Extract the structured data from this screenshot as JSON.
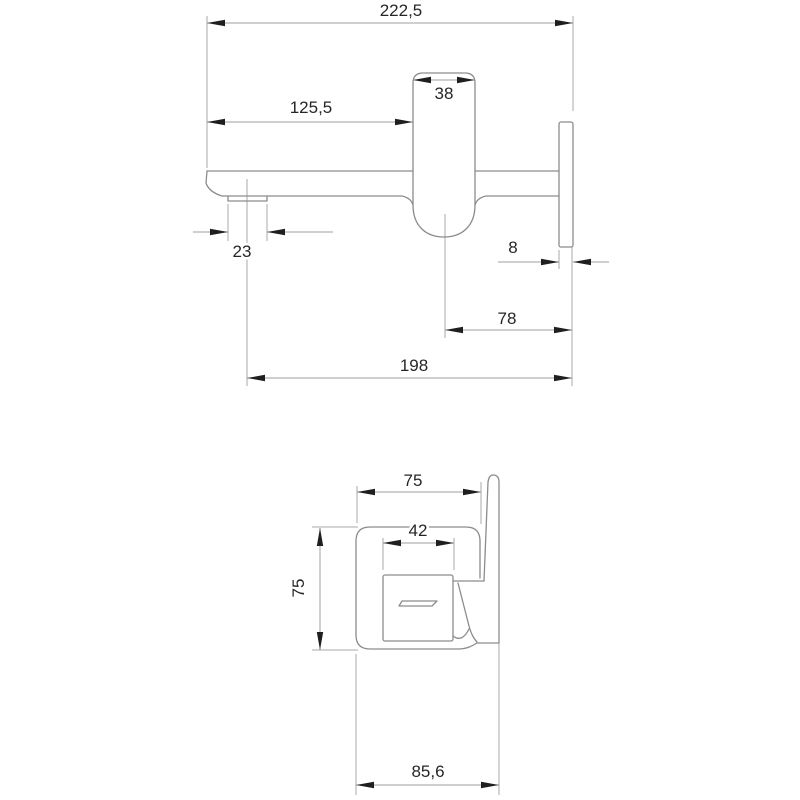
{
  "drawing": {
    "type": "technical-dimension-drawing",
    "subject": "wall-mounted basin mixer (spout side view and control unit side view)",
    "side_view": {
      "dims": {
        "total_reach": "222,5",
        "spout_to_body": "125,5",
        "body_width": "38",
        "aerator_width": "23",
        "plate_thickness": "8",
        "body_center_to_wall": "78",
        "outlet_to_wall": "198"
      }
    },
    "plan_view": {
      "dims": {
        "body_depth": "75",
        "handle_width": "42",
        "body_height": "75",
        "total_depth": "85,6"
      }
    }
  },
  "colors": {
    "background": "#ffffff",
    "outline": "#8c8c8c",
    "dimension_line": "#9f9f9f",
    "arrow": "#1f1f1f",
    "text": "#262626"
  }
}
